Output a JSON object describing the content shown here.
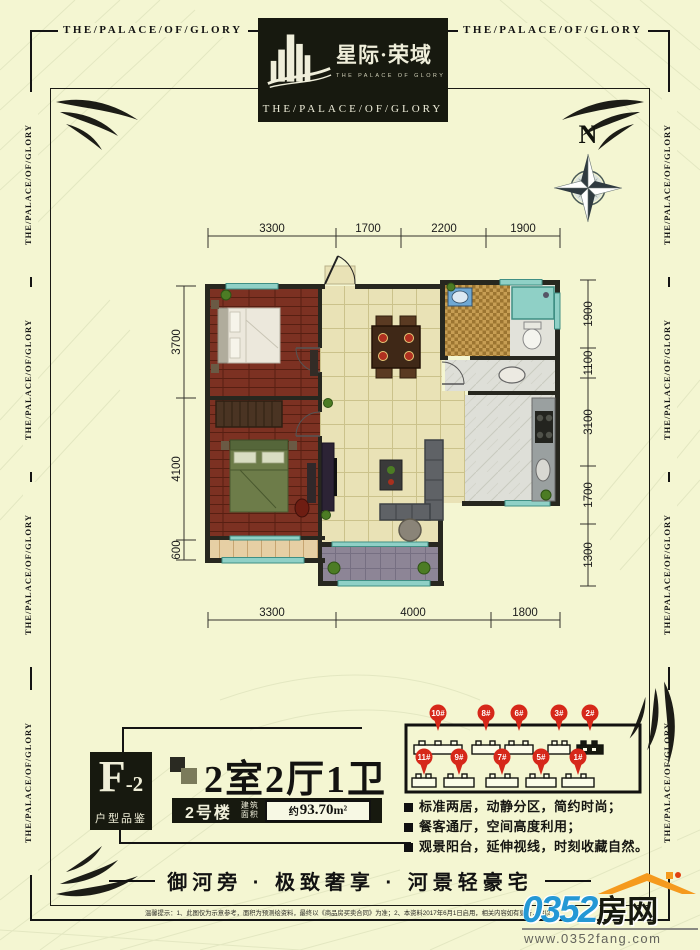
{
  "border": {
    "motto": "THE/PALACE/OF/GLORY"
  },
  "logo": {
    "cn_title": "星际·荣域",
    "en_small": "THE PALACE OF GLORY",
    "en_band": "THE/PALACE/OF/GLORY"
  },
  "compass": {
    "north": "N"
  },
  "plan": {
    "dims_top": [
      "3300",
      "1700",
      "2200",
      "1900"
    ],
    "dims_bottom": [
      "3300",
      "4000",
      "1800"
    ],
    "dims_left": [
      "3700",
      "4100",
      "600"
    ],
    "dims_right": [
      "1900",
      "1100",
      "3100",
      "1700",
      "1300"
    ]
  },
  "unit": {
    "code": "F",
    "code_suffix": "-2",
    "code_sub": "户型品鉴",
    "rooms_title": "2室2厅1卫",
    "building_label": "2号楼",
    "area_label_l1": "建筑",
    "area_label_l2": "面积",
    "area_prefix": "约",
    "area_value": "93.70",
    "area_unit": "m²"
  },
  "site": {
    "pins_top": [
      "10#",
      "8#",
      "6#",
      "3#",
      "2#"
    ],
    "pins_bottom": [
      "11#",
      "9#",
      "7#",
      "5#",
      "1#"
    ]
  },
  "features": [
    "标准两居，动静分区，简约时尚；",
    "餐客通厅，空间高度利用；",
    "观景阳台，延伸视线，时刻收藏自然。"
  ],
  "tagline": "御河旁 · 极致奢享 · 河景轻豪宅",
  "footer": {
    "disclaimer": "温馨提示：1、此图仅为示意参考，面积为预测绘资料，最终以《商品房买卖合同》为准；2、本资料2017年6月1日启用，相关内容如有更新，请以最新资料为准。",
    "brand_num": "0352",
    "brand_cn": "房网",
    "brand_url": "www.0352fang.com"
  },
  "colors": {
    "background": "#f4f6d2",
    "ink": "#141414",
    "pin_red": "#d6281a",
    "brand_blue": "#2498d5",
    "brand_orange": "#f59a1e",
    "window_teal": "#8fd0c6",
    "bedroom_floor": "#7c3122",
    "hall_floor": "#e9e2b6"
  }
}
